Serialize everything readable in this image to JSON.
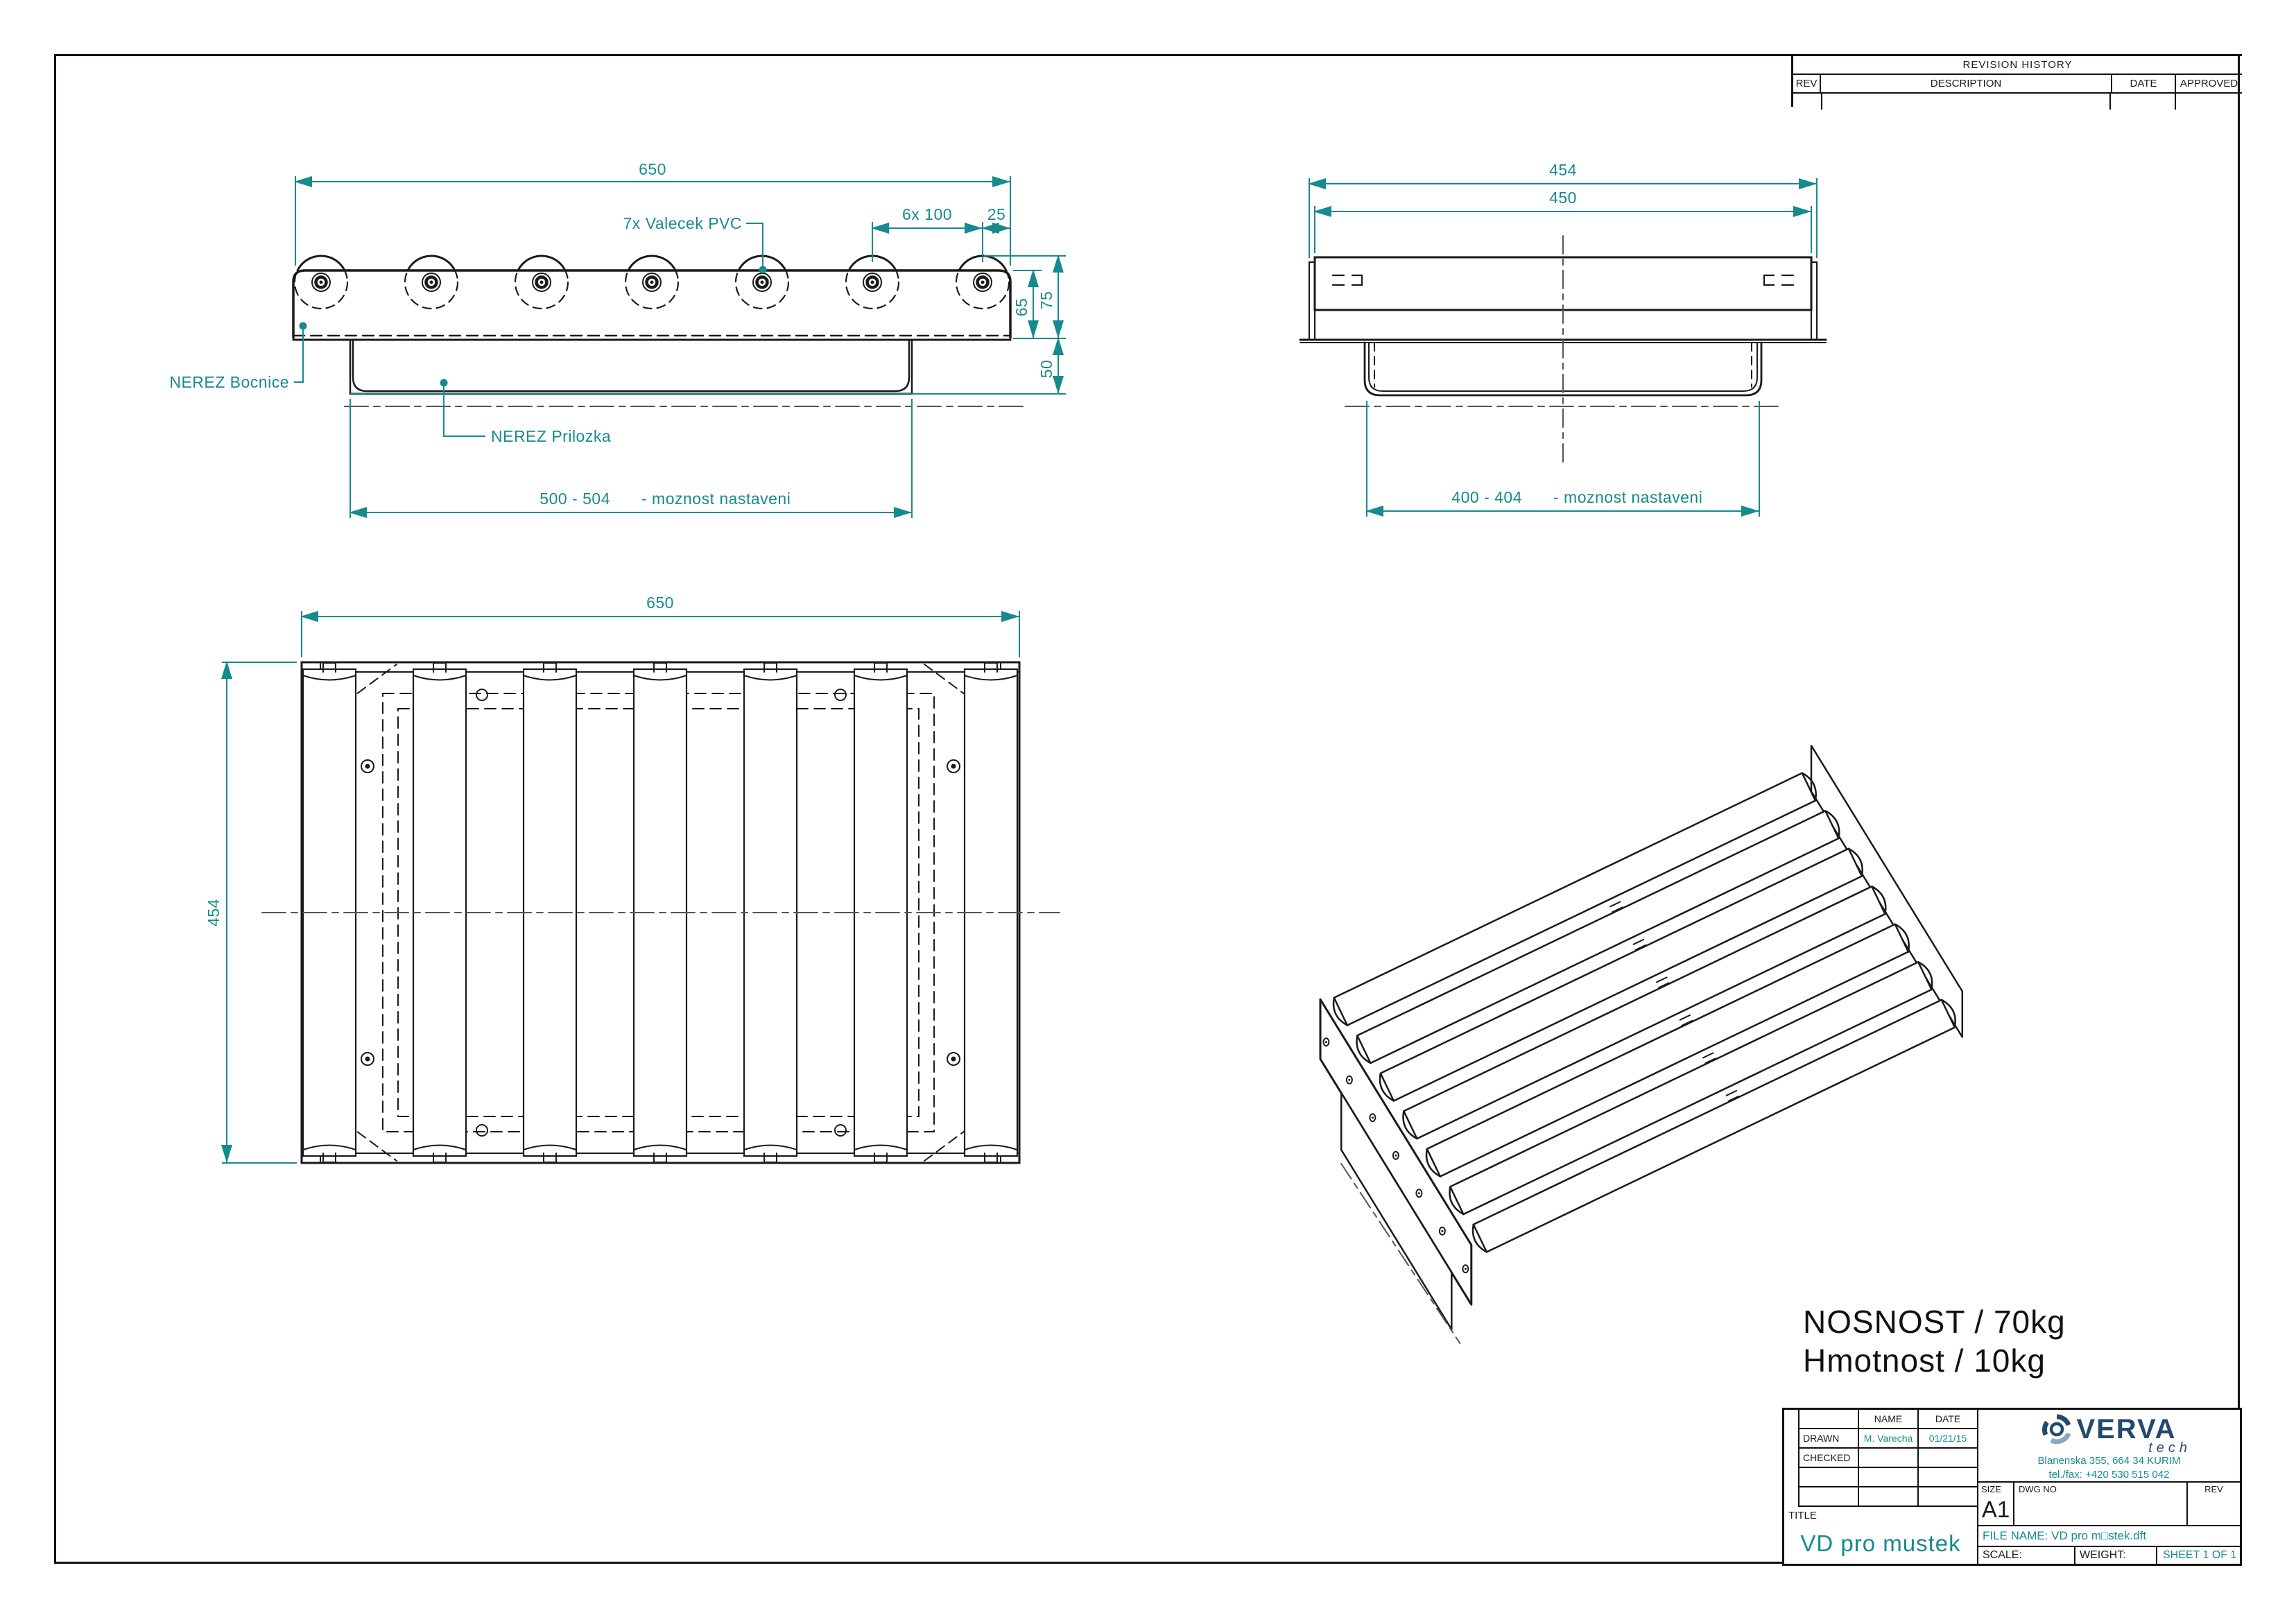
{
  "sheet": {
    "bg_color": "#ffffff",
    "line_color": "#1a1a1a",
    "dim_color": "#178a8e",
    "logo_navy": "#24496e",
    "logo_light_blue": "#86a8c8"
  },
  "revision_table": {
    "title": "REVISION HISTORY",
    "col_rev": "REV",
    "col_desc": "DESCRIPTION",
    "col_date": "DATE",
    "col_approved": "APPROVED"
  },
  "notes": {
    "capacity": "NOSNOST / 70kg",
    "weight": "Hmotnost / 10kg"
  },
  "front_view": {
    "roller_count": 7,
    "dim_width": "650",
    "label_roller": "7x Valecek PVC",
    "dim_pitch": "6x  100",
    "dim_end": "25",
    "dim_roller_height": "75",
    "dim_rail_height": "65",
    "dim_bracket_height": "50",
    "label_side_plate": "NEREZ Bocnice",
    "label_insert": "NEREZ Prilozka",
    "dim_adjust": "500 - 504",
    "note_adjust": "- moznost nastaveni"
  },
  "side_view": {
    "dim_outer": "454",
    "dim_inner": "450",
    "dim_adjust": "400 - 404",
    "note_adjust": "- moznost nastaveni"
  },
  "plan_view": {
    "roller_count": 7,
    "dim_width": "650",
    "dim_depth": "454"
  },
  "iso_view": {
    "roller_count": 7
  },
  "title_block": {
    "header_name": "NAME",
    "header_date": "DATE",
    "rows": [
      {
        "label": "DRAWN",
        "name": "M. Varecha",
        "date": "01/21/15"
      },
      {
        "label": "CHECKED",
        "name": "",
        "date": ""
      },
      {
        "label": "",
        "name": "",
        "date": ""
      },
      {
        "label": "",
        "name": "",
        "date": ""
      }
    ],
    "title_label": "TITLE",
    "title": "VD pro mustek",
    "size_label": "SIZE",
    "size": "A1",
    "dwg_label": "DWG NO",
    "rev_label": "REV",
    "file_name": "FILE NAME: VD pro m□stek.dft",
    "scale_label": "SCALE:",
    "weight_label": "WEIGHT:",
    "sheet_label": "SHEET 1 OF 1"
  },
  "company": {
    "brand": "VERVA",
    "brand_sub": "tech",
    "address": "Blanenska 355, 664 34 KURIM",
    "phone": "tel./fax: +420 530 515 042"
  }
}
